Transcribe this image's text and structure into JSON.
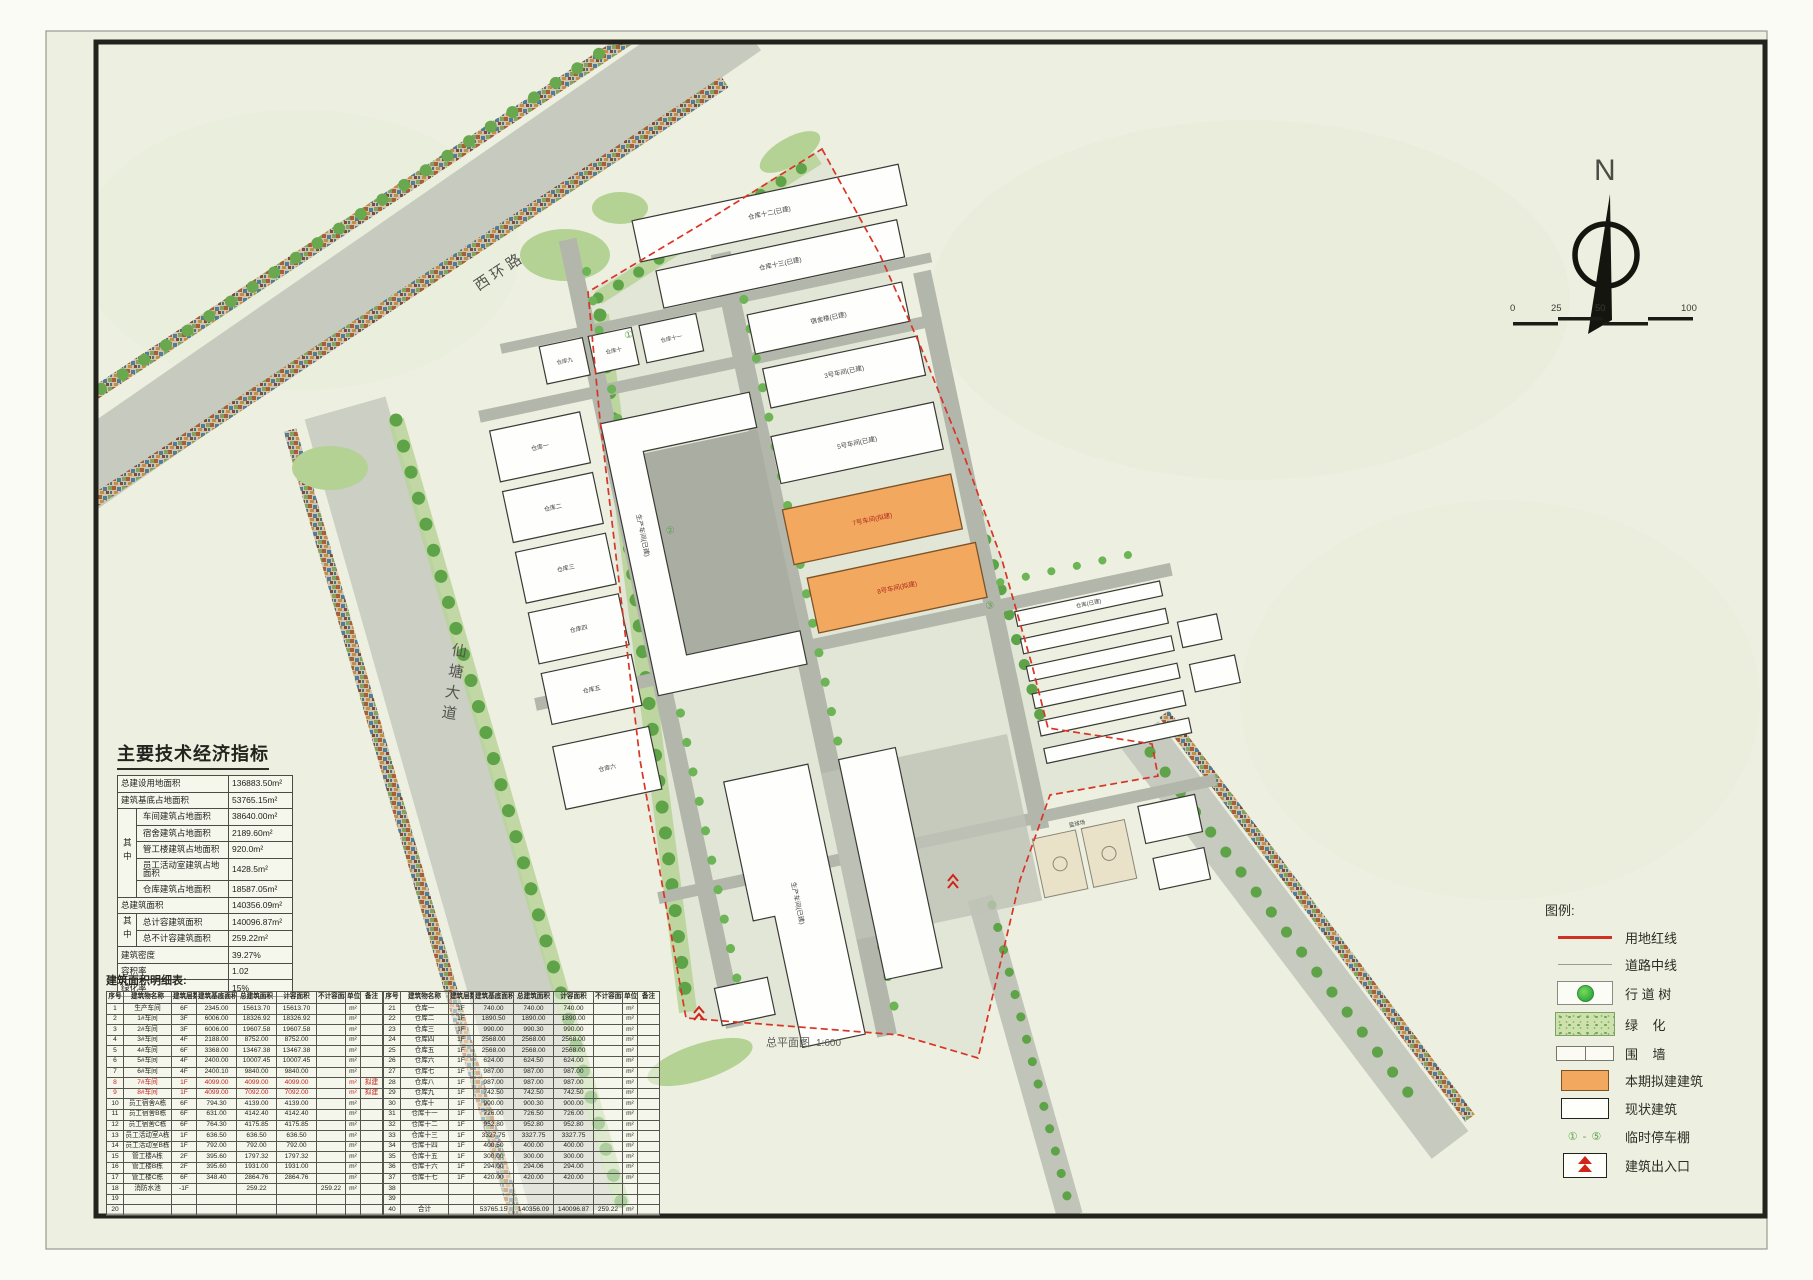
{
  "drawing": {
    "caption": "总平面图",
    "caption_scale": "1:600",
    "north_label": "N",
    "scale_ticks": [
      "0",
      "25",
      "50",
      "100"
    ]
  },
  "roads": {
    "west_ring": "西环路",
    "xiantang_avenue": "仙塘大道"
  },
  "colors": {
    "proposed_orange": "#f2a85e",
    "boundary_red": "#d93425",
    "greenery_green": "#6aa84f",
    "road_gray": "#c6cabf",
    "paper": "#edf0e0"
  },
  "indicators": {
    "title": "主要技术经济指标",
    "group_label": "其中",
    "rows": [
      {
        "label": "总建设用地面积",
        "value": "136883.50m²"
      },
      {
        "label": "建筑基底占地面积",
        "value": "53765.15m²"
      },
      {
        "label": "车间建筑占地面积",
        "value": "38640.00m²",
        "group_span": 5
      },
      {
        "label": "宿舍建筑占地面积",
        "value": "2189.60m²",
        "in_group": true
      },
      {
        "label": "管工楼建筑占地面积",
        "value": "920.0m²",
        "in_group": true
      },
      {
        "label": "员工活动室建筑占地面积",
        "value": "1428.5m²",
        "in_group": true
      },
      {
        "label": "仓库建筑占地面积",
        "value": "18587.05m²",
        "in_group": true
      },
      {
        "label": "总建筑面积",
        "value": "140356.09m²"
      },
      {
        "label": "总计容建筑面积",
        "value": "140096.87m²",
        "group_span": 2
      },
      {
        "label": "总不计容建筑面积",
        "value": "259.22m²",
        "in_group": true
      },
      {
        "label": "建筑密度",
        "value": "39.27%"
      },
      {
        "label": "容积率",
        "value": "1.02"
      },
      {
        "label": "绿化率",
        "value": "15%"
      }
    ]
  },
  "detail_table": {
    "title": "建筑面积明细表:",
    "headers": [
      "序号",
      "建筑物名称",
      "建筑层数",
      "建筑基底面积",
      "总建筑面积",
      "计容面积",
      "不计容面积",
      "单位",
      "备注"
    ],
    "red_rows": [
      8,
      9
    ],
    "rows": [
      [
        "1",
        "生产车间",
        "6F",
        "2345.00",
        "15613.70",
        "15613.70",
        "",
        "m²",
        ""
      ],
      [
        "2",
        "1#车间",
        "3F",
        "6006.00",
        "18326.92",
        "18326.92",
        "",
        "m²",
        ""
      ],
      [
        "3",
        "2#车间",
        "3F",
        "6006.00",
        "19607.58",
        "19607.58",
        "",
        "m²",
        ""
      ],
      [
        "4",
        "3#车间",
        "4F",
        "2188.00",
        "8752.00",
        "8752.00",
        "",
        "m²",
        ""
      ],
      [
        "5",
        "4#车间",
        "6F",
        "3368.00",
        "13467.38",
        "13467.38",
        "",
        "m²",
        ""
      ],
      [
        "6",
        "5#车间",
        "4F",
        "2400.00",
        "10007.45",
        "10007.45",
        "",
        "m²",
        ""
      ],
      [
        "7",
        "6#车间",
        "4F",
        "2400.10",
        "9840.00",
        "9840.00",
        "",
        "m²",
        ""
      ],
      [
        "8",
        "7#车间",
        "1F",
        "4099.00",
        "4099.00",
        "4099.00",
        "",
        "m²",
        "拟建"
      ],
      [
        "9",
        "8#车间",
        "1F",
        "4099.00",
        "7092.00",
        "7092.00",
        "",
        "m²",
        "拟建"
      ],
      [
        "10",
        "员工宿舍A栋",
        "6F",
        "794.30",
        "4139.00",
        "4139.00",
        "",
        "m²",
        ""
      ],
      [
        "11",
        "员工宿舍B栋",
        "6F",
        "631.00",
        "4142.40",
        "4142.40",
        "",
        "m²",
        ""
      ],
      [
        "12",
        "员工宿舍C栋",
        "6F",
        "764.30",
        "4175.85",
        "4175.85",
        "",
        "m²",
        ""
      ],
      [
        "13",
        "员工活动室A栋",
        "1F",
        "636.50",
        "636.50",
        "636.50",
        "",
        "m²",
        ""
      ],
      [
        "14",
        "员工活动室B栋",
        "1F",
        "792.00",
        "792.00",
        "792.00",
        "",
        "m²",
        ""
      ],
      [
        "15",
        "管工楼A栋",
        "2F",
        "395.60",
        "1797.32",
        "1797.32",
        "",
        "m²",
        ""
      ],
      [
        "16",
        "管工楼B栋",
        "2F",
        "395.60",
        "1931.00",
        "1931.00",
        "",
        "m²",
        ""
      ],
      [
        "17",
        "管工楼C栋",
        "6F",
        "348.40",
        "2864.76",
        "2864.76",
        "",
        "m²",
        ""
      ],
      [
        "18",
        "消防水池",
        "-1F",
        "",
        "259.22",
        "",
        "259.22",
        "m²",
        ""
      ],
      [
        "19",
        "",
        "",
        "",
        "",
        "",
        "",
        "",
        ""
      ],
      [
        "20",
        "",
        "",
        "",
        "",
        "",
        "",
        "",
        ""
      ],
      [
        "21",
        "仓库一",
        "1F",
        "740.00",
        "740.00",
        "740.00",
        "",
        "m²",
        ""
      ],
      [
        "22",
        "仓库二",
        "1F",
        "1890.50",
        "1890.00",
        "1890.00",
        "",
        "m²",
        ""
      ],
      [
        "23",
        "仓库三",
        "1F",
        "990.00",
        "990.30",
        "990.00",
        "",
        "m²",
        ""
      ],
      [
        "24",
        "仓库四",
        "1F",
        "2568.00",
        "2568.00",
        "2568.00",
        "",
        "m²",
        ""
      ],
      [
        "25",
        "仓库五",
        "1F",
        "2568.00",
        "2568.00",
        "2568.00",
        "",
        "m²",
        ""
      ],
      [
        "26",
        "仓库六",
        "1F",
        "624.00",
        "624.50",
        "624.00",
        "",
        "m²",
        ""
      ],
      [
        "27",
        "仓库七",
        "1F",
        "987.00",
        "987.00",
        "987.00",
        "",
        "m²",
        ""
      ],
      [
        "28",
        "仓库八",
        "1F",
        "987.00",
        "987.00",
        "987.00",
        "",
        "m²",
        ""
      ],
      [
        "29",
        "仓库九",
        "1F",
        "742.50",
        "742.50",
        "742.50",
        "",
        "m²",
        ""
      ],
      [
        "30",
        "仓库十",
        "1F",
        "900.00",
        "900.30",
        "900.00",
        "",
        "m²",
        ""
      ],
      [
        "31",
        "仓库十一",
        "1F",
        "726.00",
        "726.50",
        "726.00",
        "",
        "m²",
        ""
      ],
      [
        "32",
        "仓库十二",
        "1F",
        "952.80",
        "952.80",
        "952.80",
        "",
        "m²",
        ""
      ],
      [
        "33",
        "仓库十三",
        "1F",
        "3327.75",
        "3327.75",
        "3327.75",
        "",
        "m²",
        ""
      ],
      [
        "34",
        "仓库十四",
        "1F",
        "400.50",
        "400.00",
        "400.00",
        "",
        "m²",
        ""
      ],
      [
        "35",
        "仓库十五",
        "1F",
        "300.00",
        "300.00",
        "300.00",
        "",
        "m²",
        ""
      ],
      [
        "36",
        "仓库十六",
        "1F",
        "294.00",
        "294.06",
        "294.00",
        "",
        "m²",
        ""
      ],
      [
        "37",
        "仓库十七",
        "1F",
        "420.00",
        "420.00",
        "420.00",
        "",
        "m²",
        ""
      ],
      [
        "38",
        "",
        "",
        "",
        "",
        "",
        "",
        "",
        ""
      ],
      [
        "39",
        "",
        "",
        "",
        "",
        "",
        "",
        "",
        ""
      ],
      [
        "40",
        "合计",
        "",
        "53765.15",
        "140356.09",
        "140096.87",
        "259.22",
        "m²",
        ""
      ]
    ]
  },
  "legend": {
    "title": "图例:",
    "carport_range": "① - ⑤",
    "items": [
      {
        "label": "用地红线",
        "swatch": "red-line"
      },
      {
        "label": "道路中线",
        "swatch": "center-line"
      },
      {
        "label": "行 道 树",
        "swatch": "street-tree"
      },
      {
        "label": "绿    化",
        "swatch": "greenery"
      },
      {
        "label": "围    墙",
        "swatch": "wall"
      },
      {
        "label": "本期拟建建筑",
        "swatch": "proposed"
      },
      {
        "label": "现状建筑",
        "swatch": "existing"
      },
      {
        "label": "临时停车棚",
        "swatch": "carport"
      },
      {
        "label": "建筑出入口",
        "swatch": "entrance"
      }
    ]
  },
  "plan": {
    "labels": {
      "t1": "仓库十二(已建)",
      "t2": "仓库十三(已建)",
      "u1": "仓库九",
      "u2": "仓库十",
      "u3": "仓库十一",
      "l1": "仓库一",
      "l2": "仓库二",
      "l3": "仓库三",
      "l4": "仓库四",
      "l5": "仓库五",
      "l6": "仓库六",
      "c1": "生产车间(已建)",
      "c2": "生产车间(已建)",
      "m1": "宿舍楼(已建)",
      "m2": "3号车间(已建)",
      "m3": "5号车间(已建)",
      "o1": "7号车间(拟建)",
      "o2": "8号车间(拟建)",
      "r1": "仓库(已建)",
      "s1": "篮球场"
    },
    "carport_marks": [
      "①",
      "②",
      "③"
    ]
  }
}
